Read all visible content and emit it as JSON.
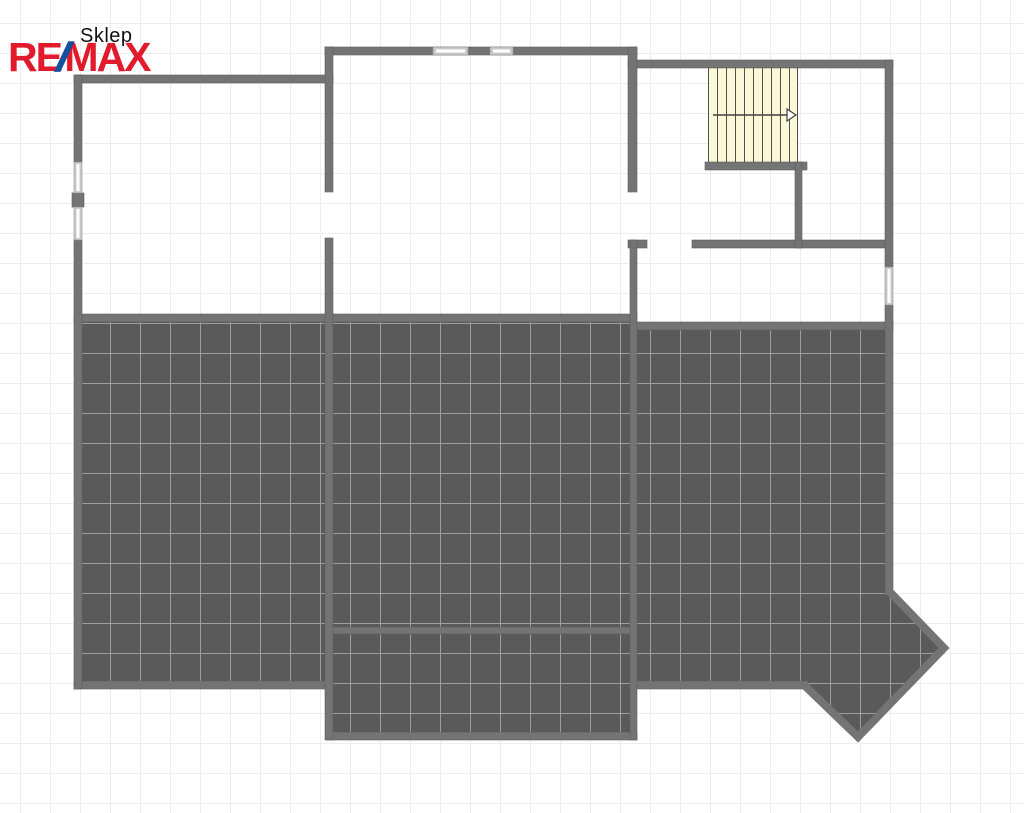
{
  "page": {
    "title": "Sklep"
  },
  "logo": {
    "re": "RE",
    "slash": "/",
    "max": "MAX"
  },
  "floorplan": {
    "stair_arrow_direction": "right",
    "tiled_zones": 4,
    "windows": 5,
    "staircase_treads": 10
  },
  "colors": {
    "logo_red": "#e11a2c",
    "logo_blue": "#164f9e",
    "title_text": "#111111",
    "wall": "#747474",
    "wall_edge": "#5e5e5e",
    "tile_fill": "#5a5a5a",
    "tile_line": "#9e9e9e",
    "bg_grid_line": "#ededed",
    "stair_fill": "#fbf8d7",
    "stair_line": "#4f4f4f",
    "window_frame": "#c9c9c9",
    "window_edge": "#8f8f8f",
    "window_glass": "#ffffff"
  }
}
